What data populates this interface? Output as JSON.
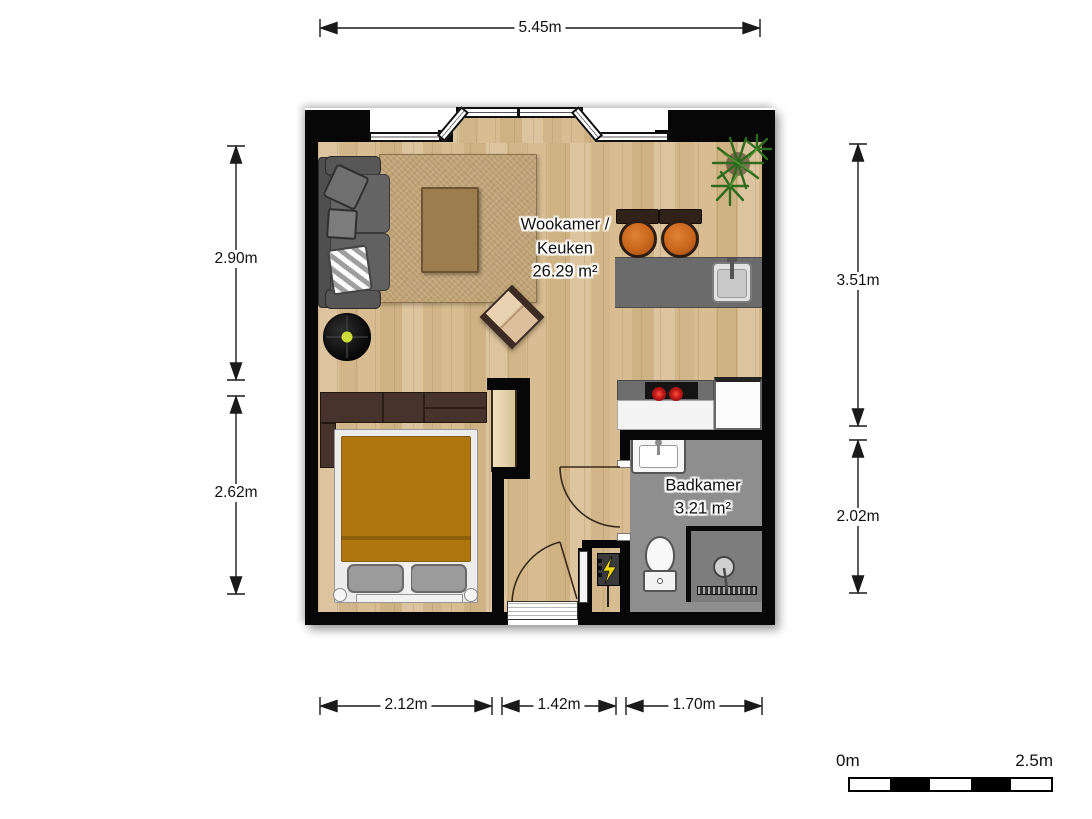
{
  "rooms": [
    {
      "line1": "Wookamer /",
      "line2": "Keuken",
      "area": "26.29 m²"
    },
    {
      "name": "Badkamer",
      "area": "3.21 m²"
    }
  ],
  "dimensions": {
    "top": "5.45m",
    "left_upper": "2.90m",
    "left_lower": "2.62m",
    "right_upper": "3.51m",
    "right_lower": "2.02m",
    "bottom_left": "2.12m",
    "bottom_center": "1.42m",
    "bottom_right": "1.70m"
  },
  "scale_bar": {
    "start_label": "0m",
    "end_label": "2.5m"
  },
  "colors": {
    "wall": "#070707",
    "wood_floor": "#d8bf96",
    "rug": "#c2a679",
    "sofa": "#5a5a5a",
    "coffee_table": "#9c7d4f",
    "armchair_cushion": "#dcbf9d",
    "bed_duvet": "#ad770e",
    "wardrobe": "#46332b",
    "kitchen_counter": "#6b6b6b",
    "stool_seat": "#c8661c",
    "plant": "#2f6b1f",
    "bathroom_floor": "#8e8e8e",
    "shower_floor": "#7d7d7d",
    "burner": "#cc2020",
    "vacuum_dot": "#cddc39",
    "bolt_yellow": "#f0d800"
  },
  "objects": [
    "sofa",
    "jute-rug",
    "coffee-table",
    "armchair",
    "robot-vacuum",
    "potted-plant",
    "bar-stool",
    "bar-stool",
    "kitchen-counter",
    "kitchen-sink",
    "cooktop",
    "kitchen-cabinet",
    "bed",
    "wardrobe",
    "bedside-cabinet",
    "washbasin",
    "toilet",
    "shower",
    "electrical-meter-panel",
    "entrance-door",
    "bathroom-door",
    "bay-window"
  ]
}
